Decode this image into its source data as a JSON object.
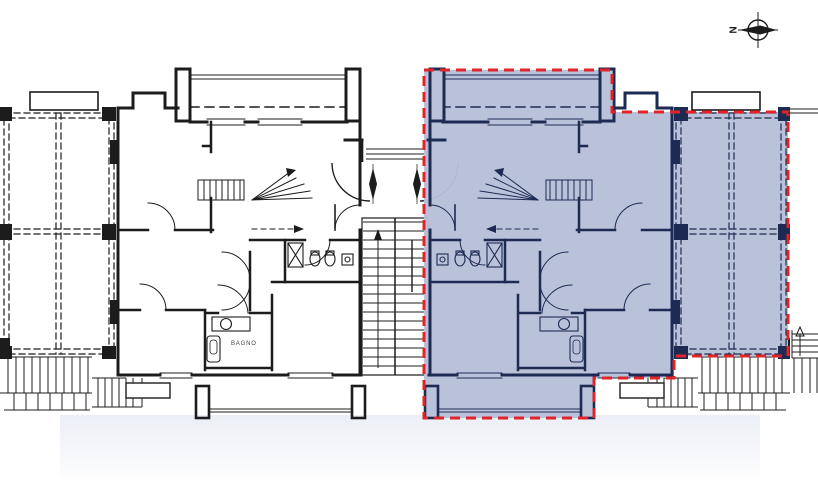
{
  "labels": {
    "bagno": "BAGNO",
    "north": "N"
  },
  "colors": {
    "line": "#1c1c1c",
    "unit_line": "#1d2b52",
    "unit_fill": "#b7c0d9",
    "boundary": "#e02428",
    "background": "#ffffff",
    "label_text": "#444444"
  },
  "highlighted_unit": {
    "state": "selected",
    "boundary_style": "dashed"
  }
}
